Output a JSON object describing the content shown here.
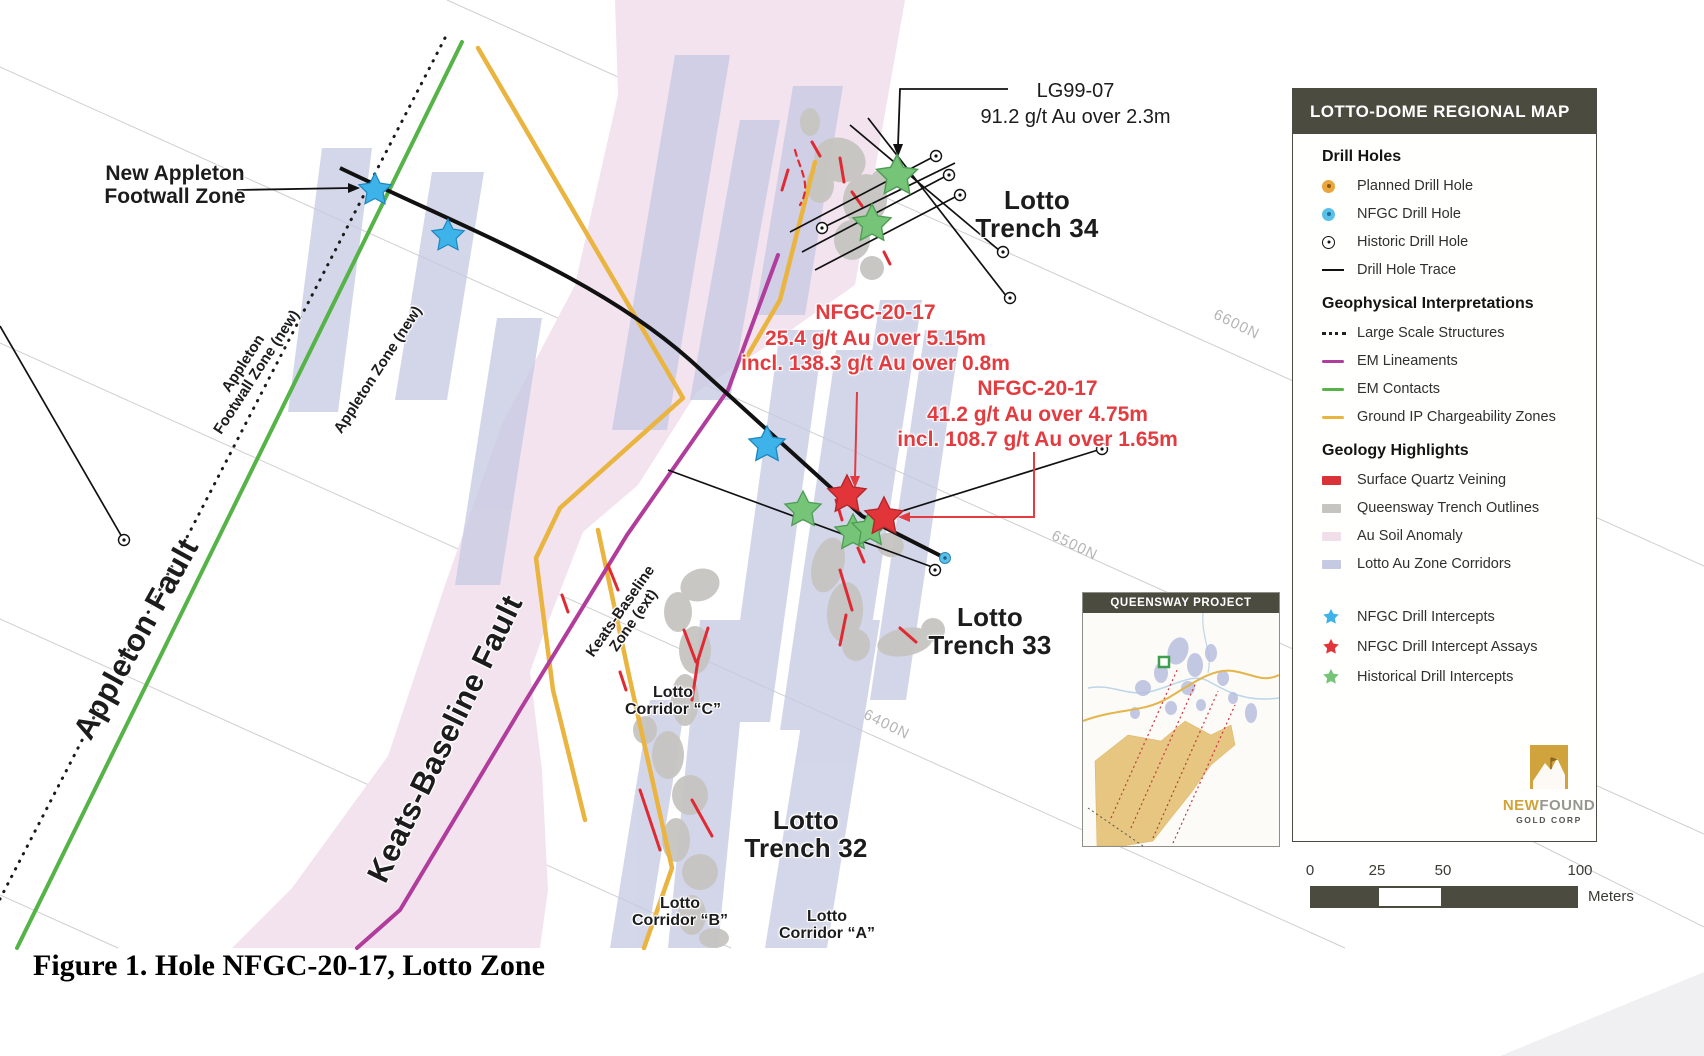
{
  "figure_caption": "Figure 1. Hole NFGC-20-17, Lotto Zone",
  "map": {
    "labels": {
      "new_appleton": [
        "New Appleton",
        "Footwall Zone"
      ],
      "appleton_footwall_new": [
        "Appleton",
        "Footwall Zone (new)"
      ],
      "appleton_zone_new": [
        "Appleton Zone (new)"
      ],
      "appleton_fault": [
        "Appleton Fault"
      ],
      "keats_baseline_fault": [
        "Keats-Baseline Fault"
      ],
      "keats_baseline_zone_ext": [
        "Keats-Baseline",
        "Zone (ext)"
      ],
      "lotto_corridor_c": [
        "Lotto",
        "Corridor “C”"
      ],
      "lotto_corridor_b": [
        "Lotto",
        "Corridor “B”"
      ],
      "lotto_corridor_a": [
        "Lotto",
        "Corridor “A”"
      ],
      "lotto_trench_34": [
        "Lotto",
        "Trench 34"
      ],
      "lotto_trench_33": [
        "Lotto",
        "Trench 33"
      ],
      "lotto_trench_32": [
        "Lotto",
        "Trench 32"
      ]
    },
    "grid_labels": [
      "6600N",
      "6500N",
      "6400N"
    ],
    "annotations": {
      "lg99": [
        "LG99-07",
        "91.2 g/t Au over 2.3m"
      ],
      "nfgc_a": [
        "NFGC-20-17",
        "25.4 g/t Au over 5.15m",
        "incl. 138.3 g/t Au over 0.8m"
      ],
      "nfgc_b": [
        "NFGC-20-17",
        "41.2 g/t Au over 4.75m",
        "incl. 108.7 g/t Au over 1.65m"
      ]
    }
  },
  "legend": {
    "title": "LOTTO-DOME REGIONAL MAP",
    "sections": [
      {
        "heading": "Drill Holes",
        "items": [
          {
            "icon": "planned-drill-hole-icon",
            "label": "Planned Drill Hole"
          },
          {
            "icon": "nfgc-drill-hole-icon",
            "label": "NFGC Drill Hole"
          },
          {
            "icon": "historic-drill-hole-icon",
            "label": "Historic Drill Hole"
          },
          {
            "icon": "drill-hole-trace-icon",
            "label": "Drill Hole Trace"
          }
        ]
      },
      {
        "heading": "Geophysical Interpretations",
        "items": [
          {
            "icon": "large-scale-structures-icon",
            "label": "Large Scale Structures"
          },
          {
            "icon": "em-lineaments-icon",
            "label": "EM Lineaments"
          },
          {
            "icon": "em-contacts-icon",
            "label": "EM Contacts"
          },
          {
            "icon": "ground-ip-chargeability-icon",
            "label": "Ground IP Chargeability Zones"
          }
        ]
      },
      {
        "heading": "Geology Highlights",
        "items": [
          {
            "icon": "surface-quartz-veining-icon",
            "label": "Surface Quartz Veining"
          },
          {
            "icon": "queensway-trench-outlines-icon",
            "label": "Queensway Trench Outlines"
          },
          {
            "icon": "au-soil-anomaly-icon",
            "label": "Au Soil Anomaly"
          },
          {
            "icon": "lotto-au-zone-corridors-icon",
            "label": "Lotto Au Zone Corridors"
          }
        ]
      }
    ],
    "stars": [
      {
        "icon": "blue-star-icon",
        "label": "NFGC Drill Intercepts"
      },
      {
        "icon": "red-star-icon",
        "label": "NFGC Drill Intercept Assays"
      },
      {
        "icon": "green-star-icon",
        "label": "Historical Drill Intercepts"
      }
    ]
  },
  "inset_title": "QUEENSWAY PROJECT",
  "scale_bar": {
    "ticks": [
      "0",
      "25",
      "50",
      "100"
    ],
    "unit": "Meters"
  },
  "logo": {
    "word1": "NEW",
    "word2": "FOUND",
    "subtitle": "GOLD CORP"
  },
  "colors": {
    "em_contact_green": "#55b348",
    "em_lineament_magenta": "#b03c9b",
    "ground_ip_yellow": "#eab440",
    "au_soil_pink": "#f2e3ee",
    "corridor_lavender": "#c5c9e2",
    "trench_gray": "#c6c5c1",
    "quartz_red": "#e02a33",
    "nfgc_star_blue": "#3eb3e9",
    "assay_star_red": "#e2353a",
    "historic_star_green": "#76c478",
    "panel_dark": "#4b4b40",
    "annotation_red": "#e23b40"
  }
}
